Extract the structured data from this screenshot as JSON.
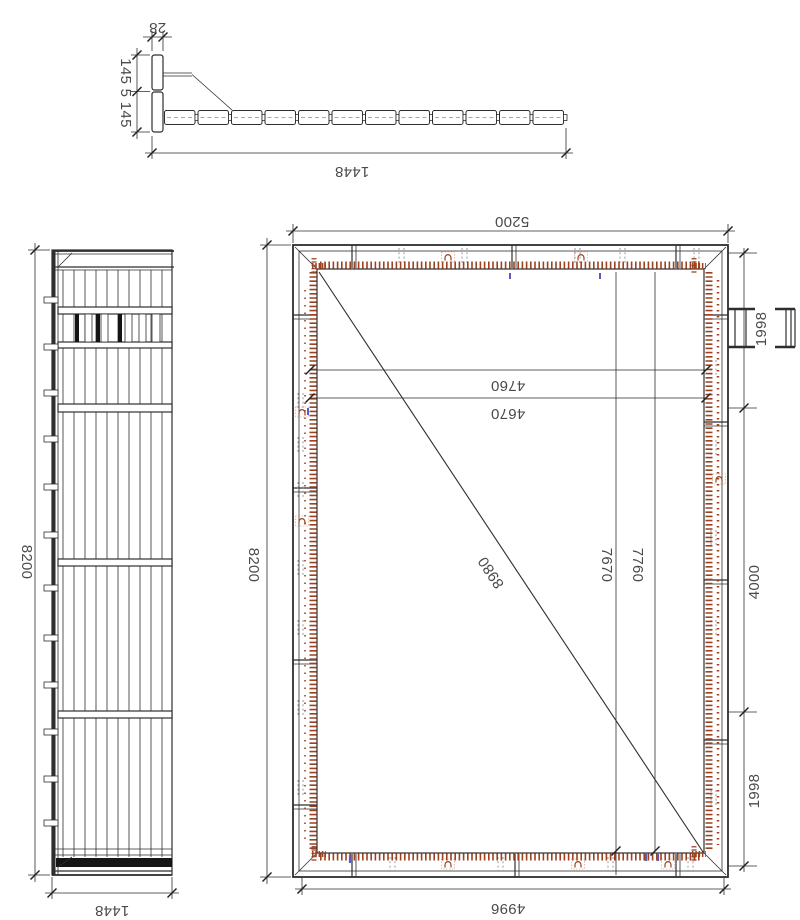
{
  "colors": {
    "line": "#2e2e2e",
    "stitch_red": "#9c4220",
    "mark_blue": "#5b5bbf",
    "dash_gray": "#9a9a9a"
  },
  "section_view": {
    "thickness": "28",
    "board_heights": "145 5 145",
    "length": "1448"
  },
  "side_view": {
    "height": "8200",
    "width": "1448"
  },
  "front_view": {
    "top_width": "5200",
    "left_height": "8200",
    "line_a": "4760",
    "line_b": "4670",
    "diagonal": "8980",
    "hole_line_a": "7670",
    "hole_line_b": "7760",
    "right_top": "1998",
    "right_middle": "4000",
    "right_bottom": "1998",
    "bottom_width": "4996"
  }
}
